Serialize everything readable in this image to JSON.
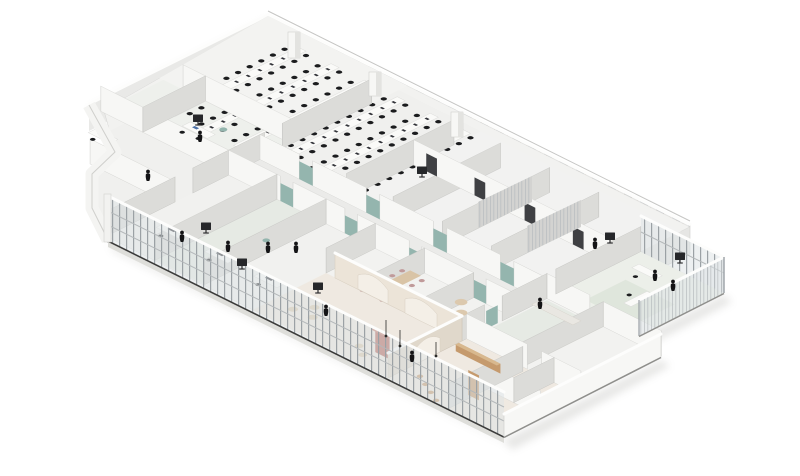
{
  "meta": {
    "kind": "axonometric-floorplan-rendering",
    "subject": "office floor cutaway, isometric view",
    "canvas": {
      "width": 800,
      "height": 476
    },
    "visible_text": ""
  },
  "palette": {
    "background": "#ffffff",
    "floor": "#f2f2f0",
    "floor_warm": "#efe9e1",
    "floor_sage": "#e6eae4",
    "glass": "#dfe3e6",
    "mullion": "#9ba1a5",
    "frame_dark": "#3b3b3a",
    "wall_bright": "#f7f7f5",
    "wall_side": "#dcdcd9",
    "wall_back": "#e8e8e7",
    "wall_cream": "#ece4d8",
    "panel_gray": "#c6c9cb",
    "stud_tan": "#b39b83",
    "desk_top": "#fafaf8",
    "wood": "#c59a6d",
    "wood_light": "#d9c4a6",
    "chair_black": "#1b1c1e",
    "person_black": "#141416",
    "accent_teal": "#94b5ae",
    "accent_terracotta": "#b5655a",
    "accent_mauve": "#c09a9a",
    "cushion": "#dcc9ae",
    "shadow": "#c9c9c6"
  },
  "scene": {
    "zones": [
      {
        "id": "open-plan-office",
        "desk_rows": 6,
        "seats_per_row": 22
      },
      {
        "id": "back-wall-band"
      },
      {
        "id": "back-rooms-row"
      },
      {
        "id": "left-wing-rooms"
      },
      {
        "id": "central-corridor"
      },
      {
        "id": "mid-room-row",
        "rooms": 5
      },
      {
        "id": "cafe-lounge-arched",
        "arches": 3
      },
      {
        "id": "southeast-rooms"
      },
      {
        "id": "glass-annex"
      },
      {
        "id": "curtain-wall-facade"
      }
    ],
    "figures": 12,
    "standing_displays": 7,
    "ceiling_pendants": 3
  }
}
